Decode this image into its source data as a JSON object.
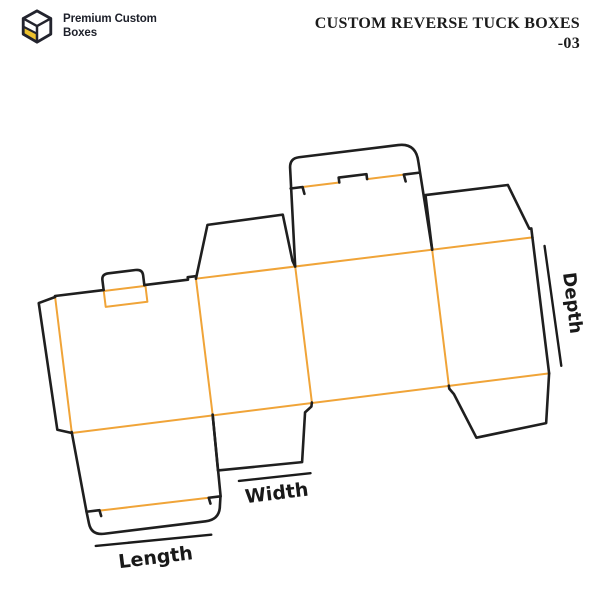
{
  "header": {
    "logo": {
      "line1": "Premium Custom",
      "line2": "Boxes"
    },
    "title": {
      "line1": "CUSTOM REVERSE TUCK BOXES",
      "line2": "-03"
    }
  },
  "diagram": {
    "labels": {
      "length": "Length",
      "width": "Width",
      "depth": "Depth"
    },
    "colors": {
      "cut_line": "#1F1F1F",
      "fold_line": "#F0A438",
      "dimension": "#1B1B1B",
      "text": "#191919",
      "logo_yellow": "#EDC22E",
      "logo_outline": "#23242E"
    }
  }
}
